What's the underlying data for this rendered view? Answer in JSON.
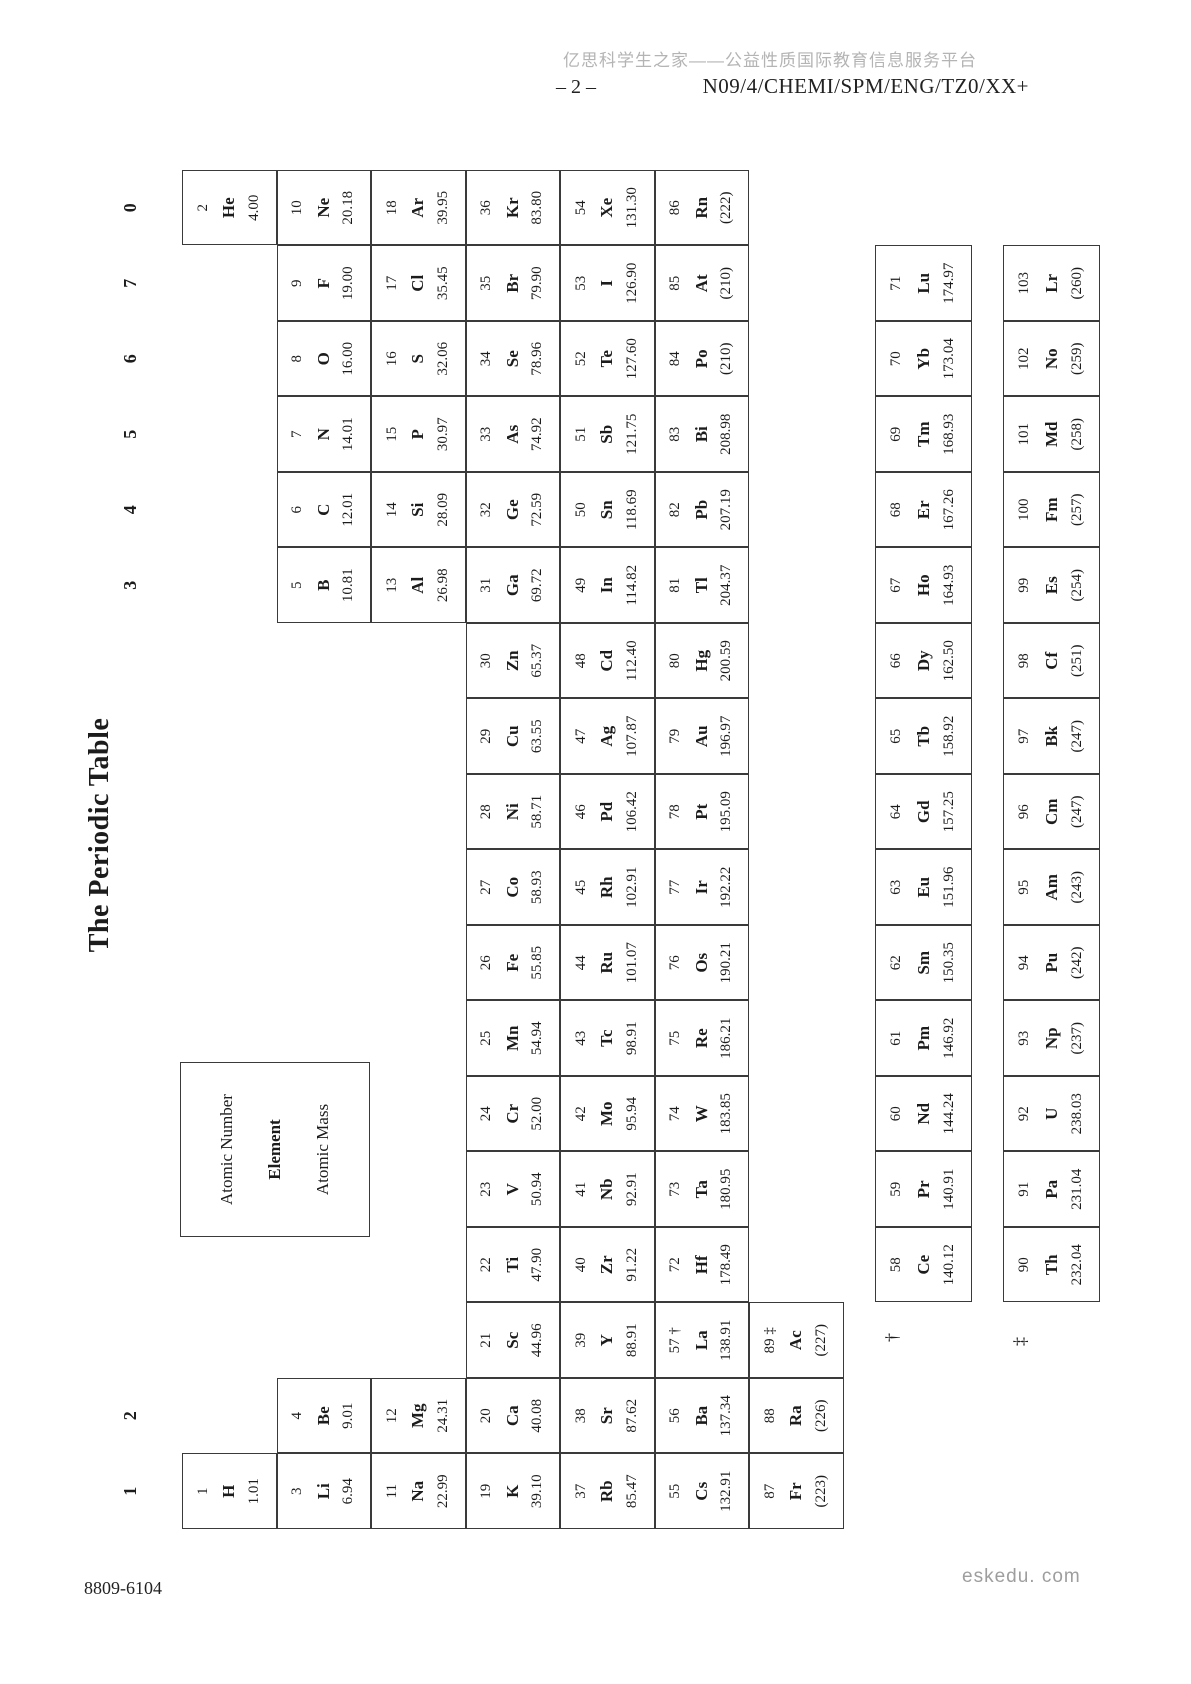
{
  "header": {
    "watermark": "亿思科学生之家——公益性质国际教育信息服务平台",
    "page_number": "– 2 –",
    "exam_code": "N09/4/CHEMI/SPM/ENG/TZ0/XX+"
  },
  "footer": {
    "doc_code": "8809-6104",
    "site": "eskedu. com"
  },
  "table": {
    "title": "The Periodic Table",
    "legend": {
      "atomic_number": "Atomic Number",
      "element": "Element",
      "atomic_mass": "Atomic Mass"
    },
    "group_labels": [
      {
        "col": 1,
        "label": "1"
      },
      {
        "col": 2,
        "label": "2"
      },
      {
        "col": 13,
        "label": "3"
      },
      {
        "col": 14,
        "label": "4"
      },
      {
        "col": 15,
        "label": "5"
      },
      {
        "col": 16,
        "label": "6"
      },
      {
        "col": 17,
        "label": "7"
      },
      {
        "col": 18,
        "label": "0"
      }
    ],
    "elements": [
      {
        "z": "1",
        "sym": "H",
        "mass": "1.01",
        "period": 1,
        "col": 1
      },
      {
        "z": "2",
        "sym": "He",
        "mass": "4.00",
        "period": 1,
        "col": 18
      },
      {
        "z": "3",
        "sym": "Li",
        "mass": "6.94",
        "period": 2,
        "col": 1
      },
      {
        "z": "4",
        "sym": "Be",
        "mass": "9.01",
        "period": 2,
        "col": 2
      },
      {
        "z": "5",
        "sym": "B",
        "mass": "10.81",
        "period": 2,
        "col": 13
      },
      {
        "z": "6",
        "sym": "C",
        "mass": "12.01",
        "period": 2,
        "col": 14
      },
      {
        "z": "7",
        "sym": "N",
        "mass": "14.01",
        "period": 2,
        "col": 15
      },
      {
        "z": "8",
        "sym": "O",
        "mass": "16.00",
        "period": 2,
        "col": 16
      },
      {
        "z": "9",
        "sym": "F",
        "mass": "19.00",
        "period": 2,
        "col": 17
      },
      {
        "z": "10",
        "sym": "Ne",
        "mass": "20.18",
        "period": 2,
        "col": 18
      },
      {
        "z": "11",
        "sym": "Na",
        "mass": "22.99",
        "period": 3,
        "col": 1
      },
      {
        "z": "12",
        "sym": "Mg",
        "mass": "24.31",
        "period": 3,
        "col": 2
      },
      {
        "z": "13",
        "sym": "Al",
        "mass": "26.98",
        "period": 3,
        "col": 13
      },
      {
        "z": "14",
        "sym": "Si",
        "mass": "28.09",
        "period": 3,
        "col": 14
      },
      {
        "z": "15",
        "sym": "P",
        "mass": "30.97",
        "period": 3,
        "col": 15
      },
      {
        "z": "16",
        "sym": "S",
        "mass": "32.06",
        "period": 3,
        "col": 16
      },
      {
        "z": "17",
        "sym": "Cl",
        "mass": "35.45",
        "period": 3,
        "col": 17
      },
      {
        "z": "18",
        "sym": "Ar",
        "mass": "39.95",
        "period": 3,
        "col": 18
      },
      {
        "z": "19",
        "sym": "K",
        "mass": "39.10",
        "period": 4,
        "col": 1
      },
      {
        "z": "20",
        "sym": "Ca",
        "mass": "40.08",
        "period": 4,
        "col": 2
      },
      {
        "z": "21",
        "sym": "Sc",
        "mass": "44.96",
        "period": 4,
        "col": 3
      },
      {
        "z": "22",
        "sym": "Ti",
        "mass": "47.90",
        "period": 4,
        "col": 4
      },
      {
        "z": "23",
        "sym": "V",
        "mass": "50.94",
        "period": 4,
        "col": 5
      },
      {
        "z": "24",
        "sym": "Cr",
        "mass": "52.00",
        "period": 4,
        "col": 6
      },
      {
        "z": "25",
        "sym": "Mn",
        "mass": "54.94",
        "period": 4,
        "col": 7
      },
      {
        "z": "26",
        "sym": "Fe",
        "mass": "55.85",
        "period": 4,
        "col": 8
      },
      {
        "z": "27",
        "sym": "Co",
        "mass": "58.93",
        "period": 4,
        "col": 9
      },
      {
        "z": "28",
        "sym": "Ni",
        "mass": "58.71",
        "period": 4,
        "col": 10
      },
      {
        "z": "29",
        "sym": "Cu",
        "mass": "63.55",
        "period": 4,
        "col": 11
      },
      {
        "z": "30",
        "sym": "Zn",
        "mass": "65.37",
        "period": 4,
        "col": 12
      },
      {
        "z": "31",
        "sym": "Ga",
        "mass": "69.72",
        "period": 4,
        "col": 13
      },
      {
        "z": "32",
        "sym": "Ge",
        "mass": "72.59",
        "period": 4,
        "col": 14
      },
      {
        "z": "33",
        "sym": "As",
        "mass": "74.92",
        "period": 4,
        "col": 15
      },
      {
        "z": "34",
        "sym": "Se",
        "mass": "78.96",
        "period": 4,
        "col": 16
      },
      {
        "z": "35",
        "sym": "Br",
        "mass": "79.90",
        "period": 4,
        "col": 17
      },
      {
        "z": "36",
        "sym": "Kr",
        "mass": "83.80",
        "period": 4,
        "col": 18
      },
      {
        "z": "37",
        "sym": "Rb",
        "mass": "85.47",
        "period": 5,
        "col": 1
      },
      {
        "z": "38",
        "sym": "Sr",
        "mass": "87.62",
        "period": 5,
        "col": 2
      },
      {
        "z": "39",
        "sym": "Y",
        "mass": "88.91",
        "period": 5,
        "col": 3
      },
      {
        "z": "40",
        "sym": "Zr",
        "mass": "91.22",
        "period": 5,
        "col": 4
      },
      {
        "z": "41",
        "sym": "Nb",
        "mass": "92.91",
        "period": 5,
        "col": 5
      },
      {
        "z": "42",
        "sym": "Mo",
        "mass": "95.94",
        "period": 5,
        "col": 6
      },
      {
        "z": "43",
        "sym": "Tc",
        "mass": "98.91",
        "period": 5,
        "col": 7
      },
      {
        "z": "44",
        "sym": "Ru",
        "mass": "101.07",
        "period": 5,
        "col": 8
      },
      {
        "z": "45",
        "sym": "Rh",
        "mass": "102.91",
        "period": 5,
        "col": 9
      },
      {
        "z": "46",
        "sym": "Pd",
        "mass": "106.42",
        "period": 5,
        "col": 10
      },
      {
        "z": "47",
        "sym": "Ag",
        "mass": "107.87",
        "period": 5,
        "col": 11
      },
      {
        "z": "48",
        "sym": "Cd",
        "mass": "112.40",
        "period": 5,
        "col": 12
      },
      {
        "z": "49",
        "sym": "In",
        "mass": "114.82",
        "period": 5,
        "col": 13
      },
      {
        "z": "50",
        "sym": "Sn",
        "mass": "118.69",
        "period": 5,
        "col": 14
      },
      {
        "z": "51",
        "sym": "Sb",
        "mass": "121.75",
        "period": 5,
        "col": 15
      },
      {
        "z": "52",
        "sym": "Te",
        "mass": "127.60",
        "period": 5,
        "col": 16
      },
      {
        "z": "53",
        "sym": "I",
        "mass": "126.90",
        "period": 5,
        "col": 17
      },
      {
        "z": "54",
        "sym": "Xe",
        "mass": "131.30",
        "period": 5,
        "col": 18
      },
      {
        "z": "55",
        "sym": "Cs",
        "mass": "132.91",
        "period": 6,
        "col": 1
      },
      {
        "z": "56",
        "sym": "Ba",
        "mass": "137.34",
        "period": 6,
        "col": 2
      },
      {
        "z": "57",
        "sym": "La",
        "mass": "138.91",
        "period": 6,
        "col": 3,
        "marker": "†"
      },
      {
        "z": "72",
        "sym": "Hf",
        "mass": "178.49",
        "period": 6,
        "col": 4
      },
      {
        "z": "73",
        "sym": "Ta",
        "mass": "180.95",
        "period": 6,
        "col": 5
      },
      {
        "z": "74",
        "sym": "W",
        "mass": "183.85",
        "period": 6,
        "col": 6
      },
      {
        "z": "75",
        "sym": "Re",
        "mass": "186.21",
        "period": 6,
        "col": 7
      },
      {
        "z": "76",
        "sym": "Os",
        "mass": "190.21",
        "period": 6,
        "col": 8
      },
      {
        "z": "77",
        "sym": "Ir",
        "mass": "192.22",
        "period": 6,
        "col": 9
      },
      {
        "z": "78",
        "sym": "Pt",
        "mass": "195.09",
        "period": 6,
        "col": 10
      },
      {
        "z": "79",
        "sym": "Au",
        "mass": "196.97",
        "period": 6,
        "col": 11
      },
      {
        "z": "80",
        "sym": "Hg",
        "mass": "200.59",
        "period": 6,
        "col": 12
      },
      {
        "z": "81",
        "sym": "Tl",
        "mass": "204.37",
        "period": 6,
        "col": 13
      },
      {
        "z": "82",
        "sym": "Pb",
        "mass": "207.19",
        "period": 6,
        "col": 14
      },
      {
        "z": "83",
        "sym": "Bi",
        "mass": "208.98",
        "period": 6,
        "col": 15
      },
      {
        "z": "84",
        "sym": "Po",
        "mass": "(210)",
        "period": 6,
        "col": 16
      },
      {
        "z": "85",
        "sym": "At",
        "mass": "(210)",
        "period": 6,
        "col": 17
      },
      {
        "z": "86",
        "sym": "Rn",
        "mass": "(222)",
        "period": 6,
        "col": 18
      },
      {
        "z": "87",
        "sym": "Fr",
        "mass": "(223)",
        "period": 7,
        "col": 1
      },
      {
        "z": "88",
        "sym": "Ra",
        "mass": "(226)",
        "period": 7,
        "col": 2
      },
      {
        "z": "89",
        "sym": "Ac",
        "mass": "(227)",
        "period": 7,
        "col": 3,
        "marker": "‡"
      }
    ],
    "lanthanides": {
      "marker": "†",
      "cells": [
        {
          "z": "58",
          "sym": "Ce",
          "mass": "140.12"
        },
        {
          "z": "59",
          "sym": "Pr",
          "mass": "140.91"
        },
        {
          "z": "60",
          "sym": "Nd",
          "mass": "144.24"
        },
        {
          "z": "61",
          "sym": "Pm",
          "mass": "146.92"
        },
        {
          "z": "62",
          "sym": "Sm",
          "mass": "150.35"
        },
        {
          "z": "63",
          "sym": "Eu",
          "mass": "151.96"
        },
        {
          "z": "64",
          "sym": "Gd",
          "mass": "157.25"
        },
        {
          "z": "65",
          "sym": "Tb",
          "mass": "158.92"
        },
        {
          "z": "66",
          "sym": "Dy",
          "mass": "162.50"
        },
        {
          "z": "67",
          "sym": "Ho",
          "mass": "164.93"
        },
        {
          "z": "68",
          "sym": "Er",
          "mass": "167.26"
        },
        {
          "z": "69",
          "sym": "Tm",
          "mass": "168.93"
        },
        {
          "z": "70",
          "sym": "Yb",
          "mass": "173.04"
        },
        {
          "z": "71",
          "sym": "Lu",
          "mass": "174.97"
        }
      ]
    },
    "actinides": {
      "marker": "‡",
      "cells": [
        {
          "z": "90",
          "sym": "Th",
          "mass": "232.04"
        },
        {
          "z": "91",
          "sym": "Pa",
          "mass": "231.04"
        },
        {
          "z": "92",
          "sym": "U",
          "mass": "238.03"
        },
        {
          "z": "93",
          "sym": "Np",
          "mass": "(237)"
        },
        {
          "z": "94",
          "sym": "Pu",
          "mass": "(242)"
        },
        {
          "z": "95",
          "sym": "Am",
          "mass": "(243)"
        },
        {
          "z": "96",
          "sym": "Cm",
          "mass": "(247)"
        },
        {
          "z": "97",
          "sym": "Bk",
          "mass": "(247)"
        },
        {
          "z": "98",
          "sym": "Cf",
          "mass": "(251)"
        },
        {
          "z": "99",
          "sym": "Es",
          "mass": "(254)"
        },
        {
          "z": "100",
          "sym": "Fm",
          "mass": "(257)"
        },
        {
          "z": "101",
          "sym": "Md",
          "mass": "(258)"
        },
        {
          "z": "102",
          "sym": "No",
          "mass": "(259)"
        },
        {
          "z": "103",
          "sym": "Lr",
          "mass": "(260)"
        }
      ]
    }
  }
}
